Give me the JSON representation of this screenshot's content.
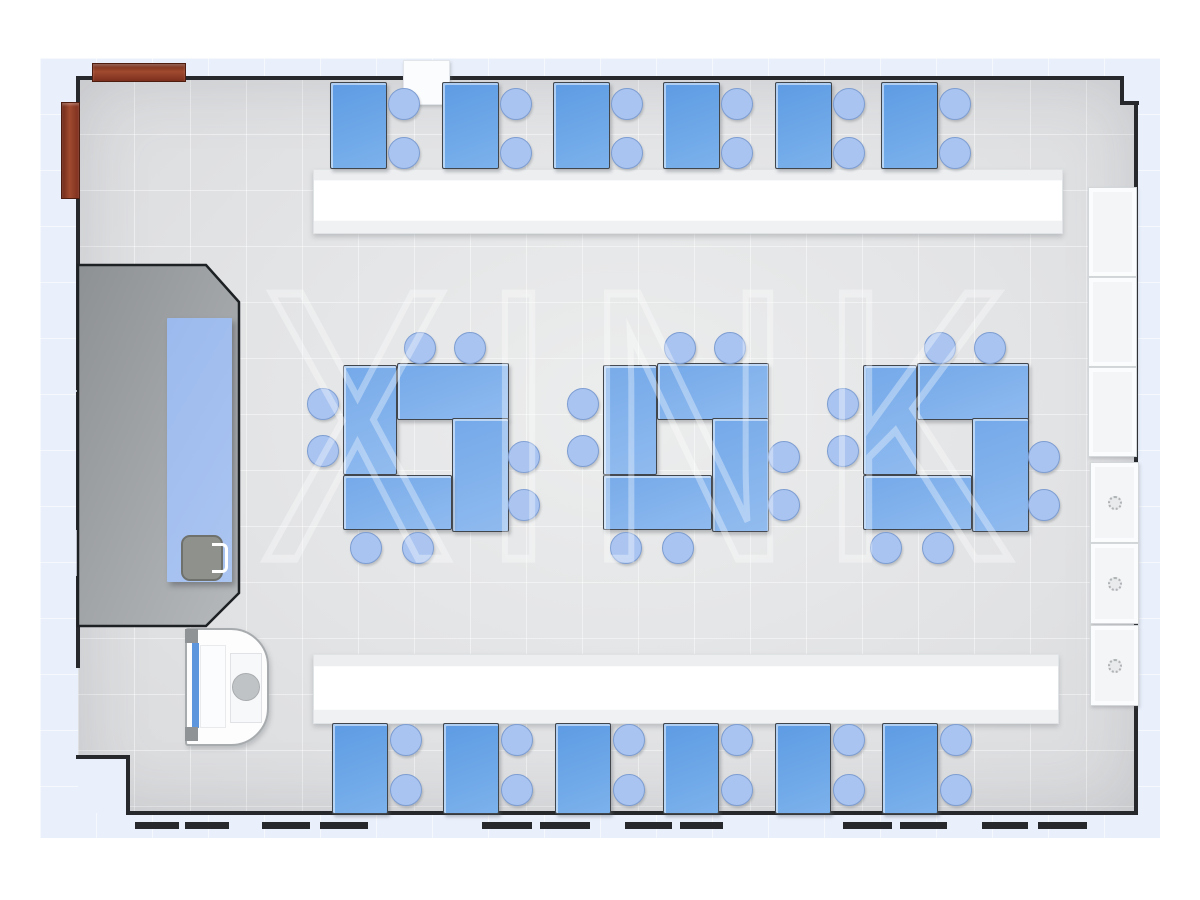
{
  "watermark": {
    "text": "XINK"
  },
  "palette": {
    "desk_blue": "#5d9be3",
    "cluster_desk_blue": "#74a9e9",
    "chair_blue": "#a9c4f0",
    "teacher_table_blue": "#9cbaee",
    "platform_gray": "#9b9ea1",
    "wall_dark": "#26282b",
    "counter_white": "#ffffff",
    "cabinet_white": "#f4f5f6",
    "wood_red": "#8a3520",
    "floor_gray": "#e3e4e6",
    "outer_floor_blue": "#e9effb"
  },
  "icons": {
    "cabinet_knob": "round-knob-icon",
    "sink_drain": "drain-circle-icon",
    "faucet": "faucet-icon"
  },
  "inventory": {
    "top_row": {
      "desk_count": 6,
      "chairs_per_desk": 2,
      "desk_xs": [
        330,
        442,
        553,
        663,
        775,
        881
      ],
      "desk_y": 82,
      "desk_w": 55,
      "desk_h": 85,
      "chair_dx": 73,
      "chair_cys": [
        103,
        152
      ]
    },
    "bottom_row": {
      "desk_count": 6,
      "chairs_per_desk": 2,
      "desk_xs": [
        332,
        443,
        555,
        663,
        775,
        882
      ],
      "desk_y": 723,
      "desk_w": 54,
      "desk_h": 89,
      "chair_dx": 73,
      "chair_cys": [
        739,
        789
      ]
    },
    "clusters": {
      "count": 3,
      "desks_per_cluster": 4,
      "chairs_per_cluster": 8,
      "origins_x": [
        343,
        603,
        863
      ],
      "origin_y": 363,
      "desk_rects": [
        [
          0,
          2,
          52,
          108
        ],
        [
          54,
          0,
          110,
          55
        ],
        [
          109,
          55,
          55,
          112
        ],
        [
          0,
          112,
          107,
          53
        ]
      ],
      "chair_centers": [
        [
          76,
          -16
        ],
        [
          126,
          -16
        ],
        [
          -21,
          40
        ],
        [
          -21,
          87
        ],
        [
          180,
          93
        ],
        [
          180,
          141
        ],
        [
          22,
          184
        ],
        [
          74,
          184
        ]
      ]
    },
    "wall_cabinets_upper": {
      "x": 1088,
      "w": 47,
      "ys": [
        187,
        277,
        367
      ],
      "h": 88
    },
    "wall_cabinets_lower": {
      "x": 1090,
      "w": 47,
      "ys": [
        462,
        543,
        625
      ],
      "h": 79
    },
    "window_dashes": [
      [
        135,
        44
      ],
      [
        185,
        44
      ],
      [
        262,
        48
      ],
      [
        320,
        48
      ],
      [
        482,
        50
      ],
      [
        540,
        50
      ],
      [
        625,
        47
      ],
      [
        680,
        43
      ],
      [
        843,
        49
      ],
      [
        900,
        47
      ],
      [
        982,
        46
      ],
      [
        1038,
        49
      ]
    ],
    "left_wall_segments": [
      [
        78,
        312
      ],
      [
        392,
        138
      ],
      [
        576,
        92
      ]
    ]
  }
}
